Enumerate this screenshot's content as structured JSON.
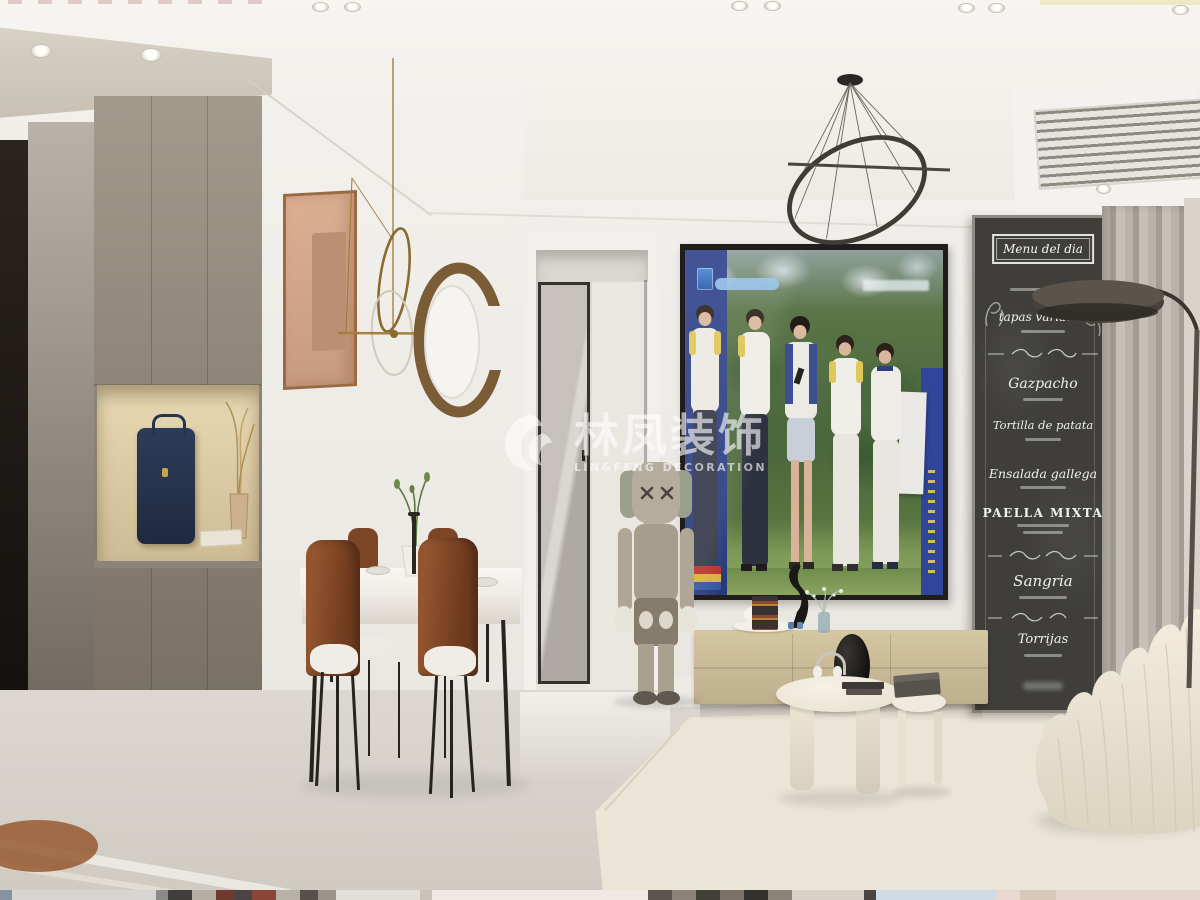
{
  "watermark": {
    "logo_icon": "phoenix-swirl",
    "brand_cn": "林凤装饰",
    "brand_en": "LIN&FENG DECORATION"
  },
  "chalkboard_menu": {
    "title": "Menu del dia",
    "items": [
      "tapas variadas",
      "Gazpacho",
      "Tortilla de patata",
      "Ensalada gallega",
      "PAELLA MIXTA",
      "Sangria",
      "Torrijas"
    ]
  },
  "palette": {
    "ceiling": "#f5f3ef",
    "wall": "#efede9",
    "soffit_taupe": "#cfc8bb",
    "entry_cabinet": "#968d7f",
    "niche_glow": "#e2d2ac",
    "dark_door": "#1d1814",
    "floor": "#d8d4cd",
    "rug": "#eae4d6",
    "tv_frame": "#1f1e1c",
    "tv_greenery": "#4a663c",
    "tv_banner_blue": "#2e4288",
    "tv_cabinet": "#cfc09e",
    "speaker": "#15130f",
    "coffee_table": "#f0eadd",
    "chalkboard": "#3f3e3a",
    "chalk_text": "#ffffff",
    "curtain": "#b2ada5",
    "accent_gold": "#a5803f",
    "chair_leather": "#7e4427",
    "sofa_cream": "#ece5d6",
    "kaws_gray": "#b0a695"
  }
}
